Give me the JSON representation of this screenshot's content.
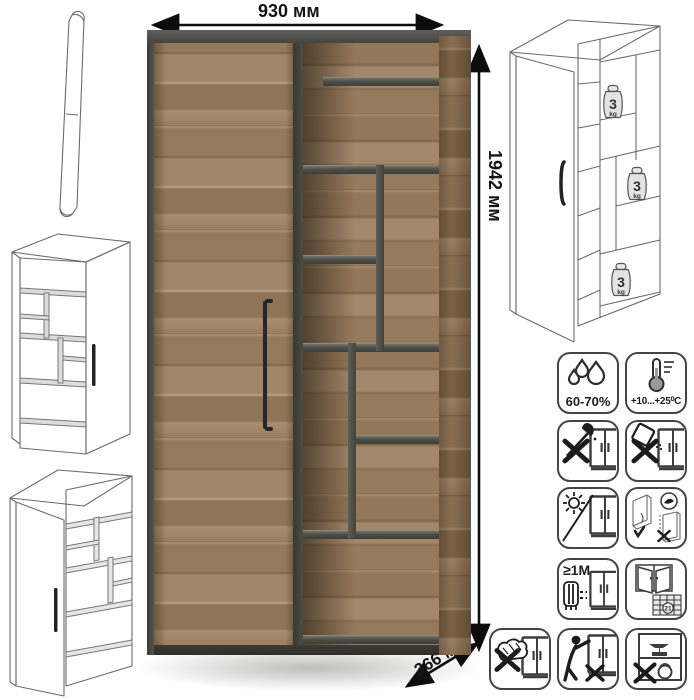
{
  "product": {
    "type": "wardrobe-bookcase",
    "views": [
      "main-photo",
      "handle-drawing",
      "mirrored-line-sketch",
      "front-line-sketch",
      "internal-structure-sketch"
    ]
  },
  "dimensions": {
    "width": "930 мм",
    "height": "1942 мм",
    "depth": "366 мм"
  },
  "shelf_load": {
    "value": "3",
    "unit": "kg",
    "instances": 3
  },
  "care": {
    "humidity": {
      "caption": "60-70%"
    },
    "temperature": {
      "caption": "+10...+25⁰C"
    },
    "distance": {
      "caption": "≥1M"
    },
    "ventilation": {
      "badge": "21"
    }
  },
  "icons": {
    "list": [
      "water-drops-icon",
      "thermometer-icon",
      "no-axe-impact-icon",
      "no-liquid-spill-icon",
      "no-direct-sunlight-icon",
      "transport-position-icon",
      "heat-source-distance-icon",
      "ventilation-window-icon",
      "no-abrasive-sponge-icon",
      "no-pulling-tipping-icon",
      "no-heavy-overload-icon"
    ]
  },
  "colors": {
    "wood": "#a1866a",
    "carcass_gray": "#46473f",
    "line_art": "#6b6b6b",
    "text": "#141414"
  }
}
